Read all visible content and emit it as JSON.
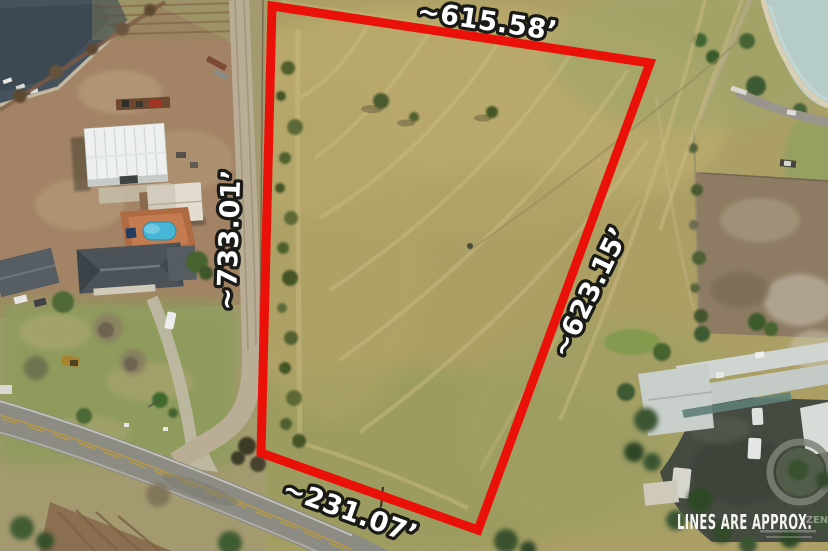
{
  "boundary": {
    "color": "#ea1208",
    "labels": {
      "top": "~615.58’",
      "left": "~733.01’",
      "right": "~623.15’",
      "bottom": "~231.07’"
    }
  },
  "footer": {
    "disclaimer": "LINES ARE APPROX.",
    "watermark": "IZEN"
  }
}
